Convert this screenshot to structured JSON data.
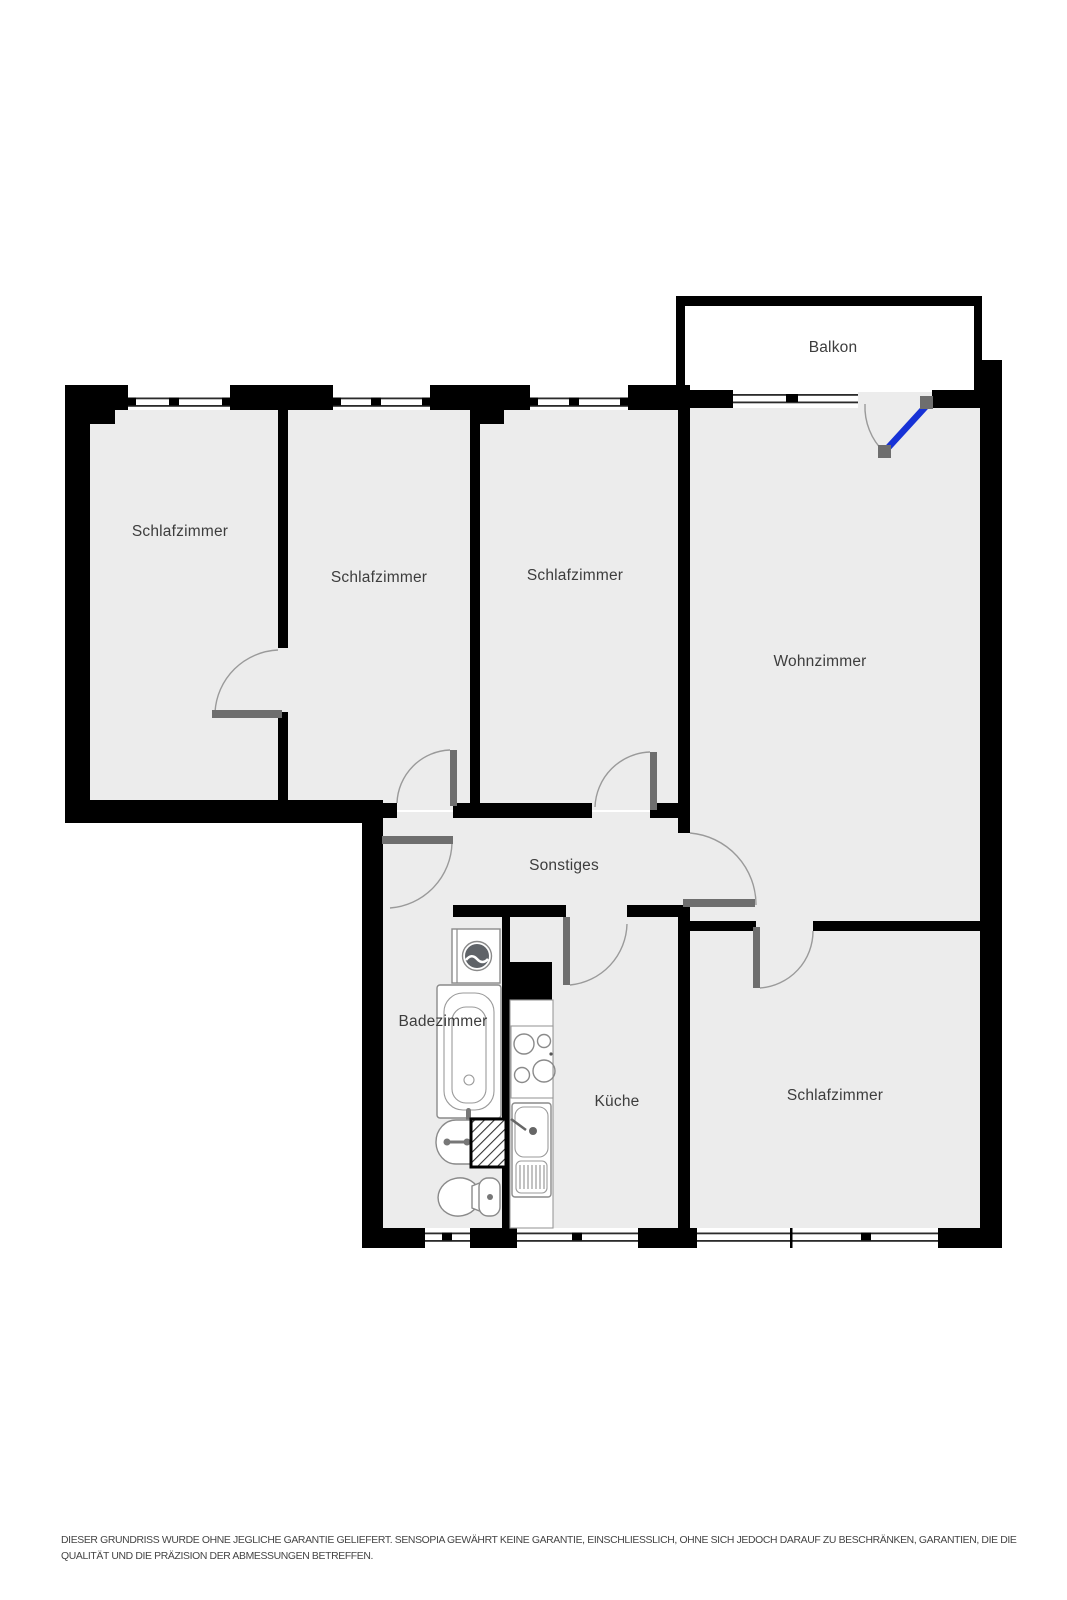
{
  "plan": {
    "rooms": [
      {
        "id": "schlafzimmer-1",
        "label": "Schlafzimmer"
      },
      {
        "id": "schlafzimmer-2",
        "label": "Schlafzimmer"
      },
      {
        "id": "schlafzimmer-3",
        "label": "Schlafzimmer"
      },
      {
        "id": "wohnzimmer",
        "label": "Wohnzimmer"
      },
      {
        "id": "balkon",
        "label": "Balkon"
      },
      {
        "id": "sonstiges",
        "label": "Sonstiges"
      },
      {
        "id": "badezimmer",
        "label": "Badezimmer"
      },
      {
        "id": "kueche",
        "label": "Küche"
      },
      {
        "id": "schlafzimmer-4",
        "label": "Schlafzimmer"
      }
    ],
    "colors": {
      "wall": "#000000",
      "floor": "#ececec",
      "balcony_floor": "#ffffff",
      "door_leaf": "#6e6e6e",
      "balcony_door": "#1732d6",
      "arc": "#9a9a9a",
      "fixture": "#8a8a8a",
      "label": "#3d3d3d",
      "disclaimer": "#444444"
    },
    "disclaimer": {
      "line1": "DIESER GRUNDRISS WURDE OHNE JEGLICHE GARANTIE GELIEFERT. SENSOPIA GEWÄHRT KEINE GARANTIE, EINSCHLIESSLICH, OHNE SICH JEDOCH DARAUF ZU BESCHRÄNKEN, GARANTIEN, DIE DIE",
      "line2": "QUALITÄT UND DIE PRÄZISION DER ABMESSUNGEN BETREFFEN."
    }
  }
}
